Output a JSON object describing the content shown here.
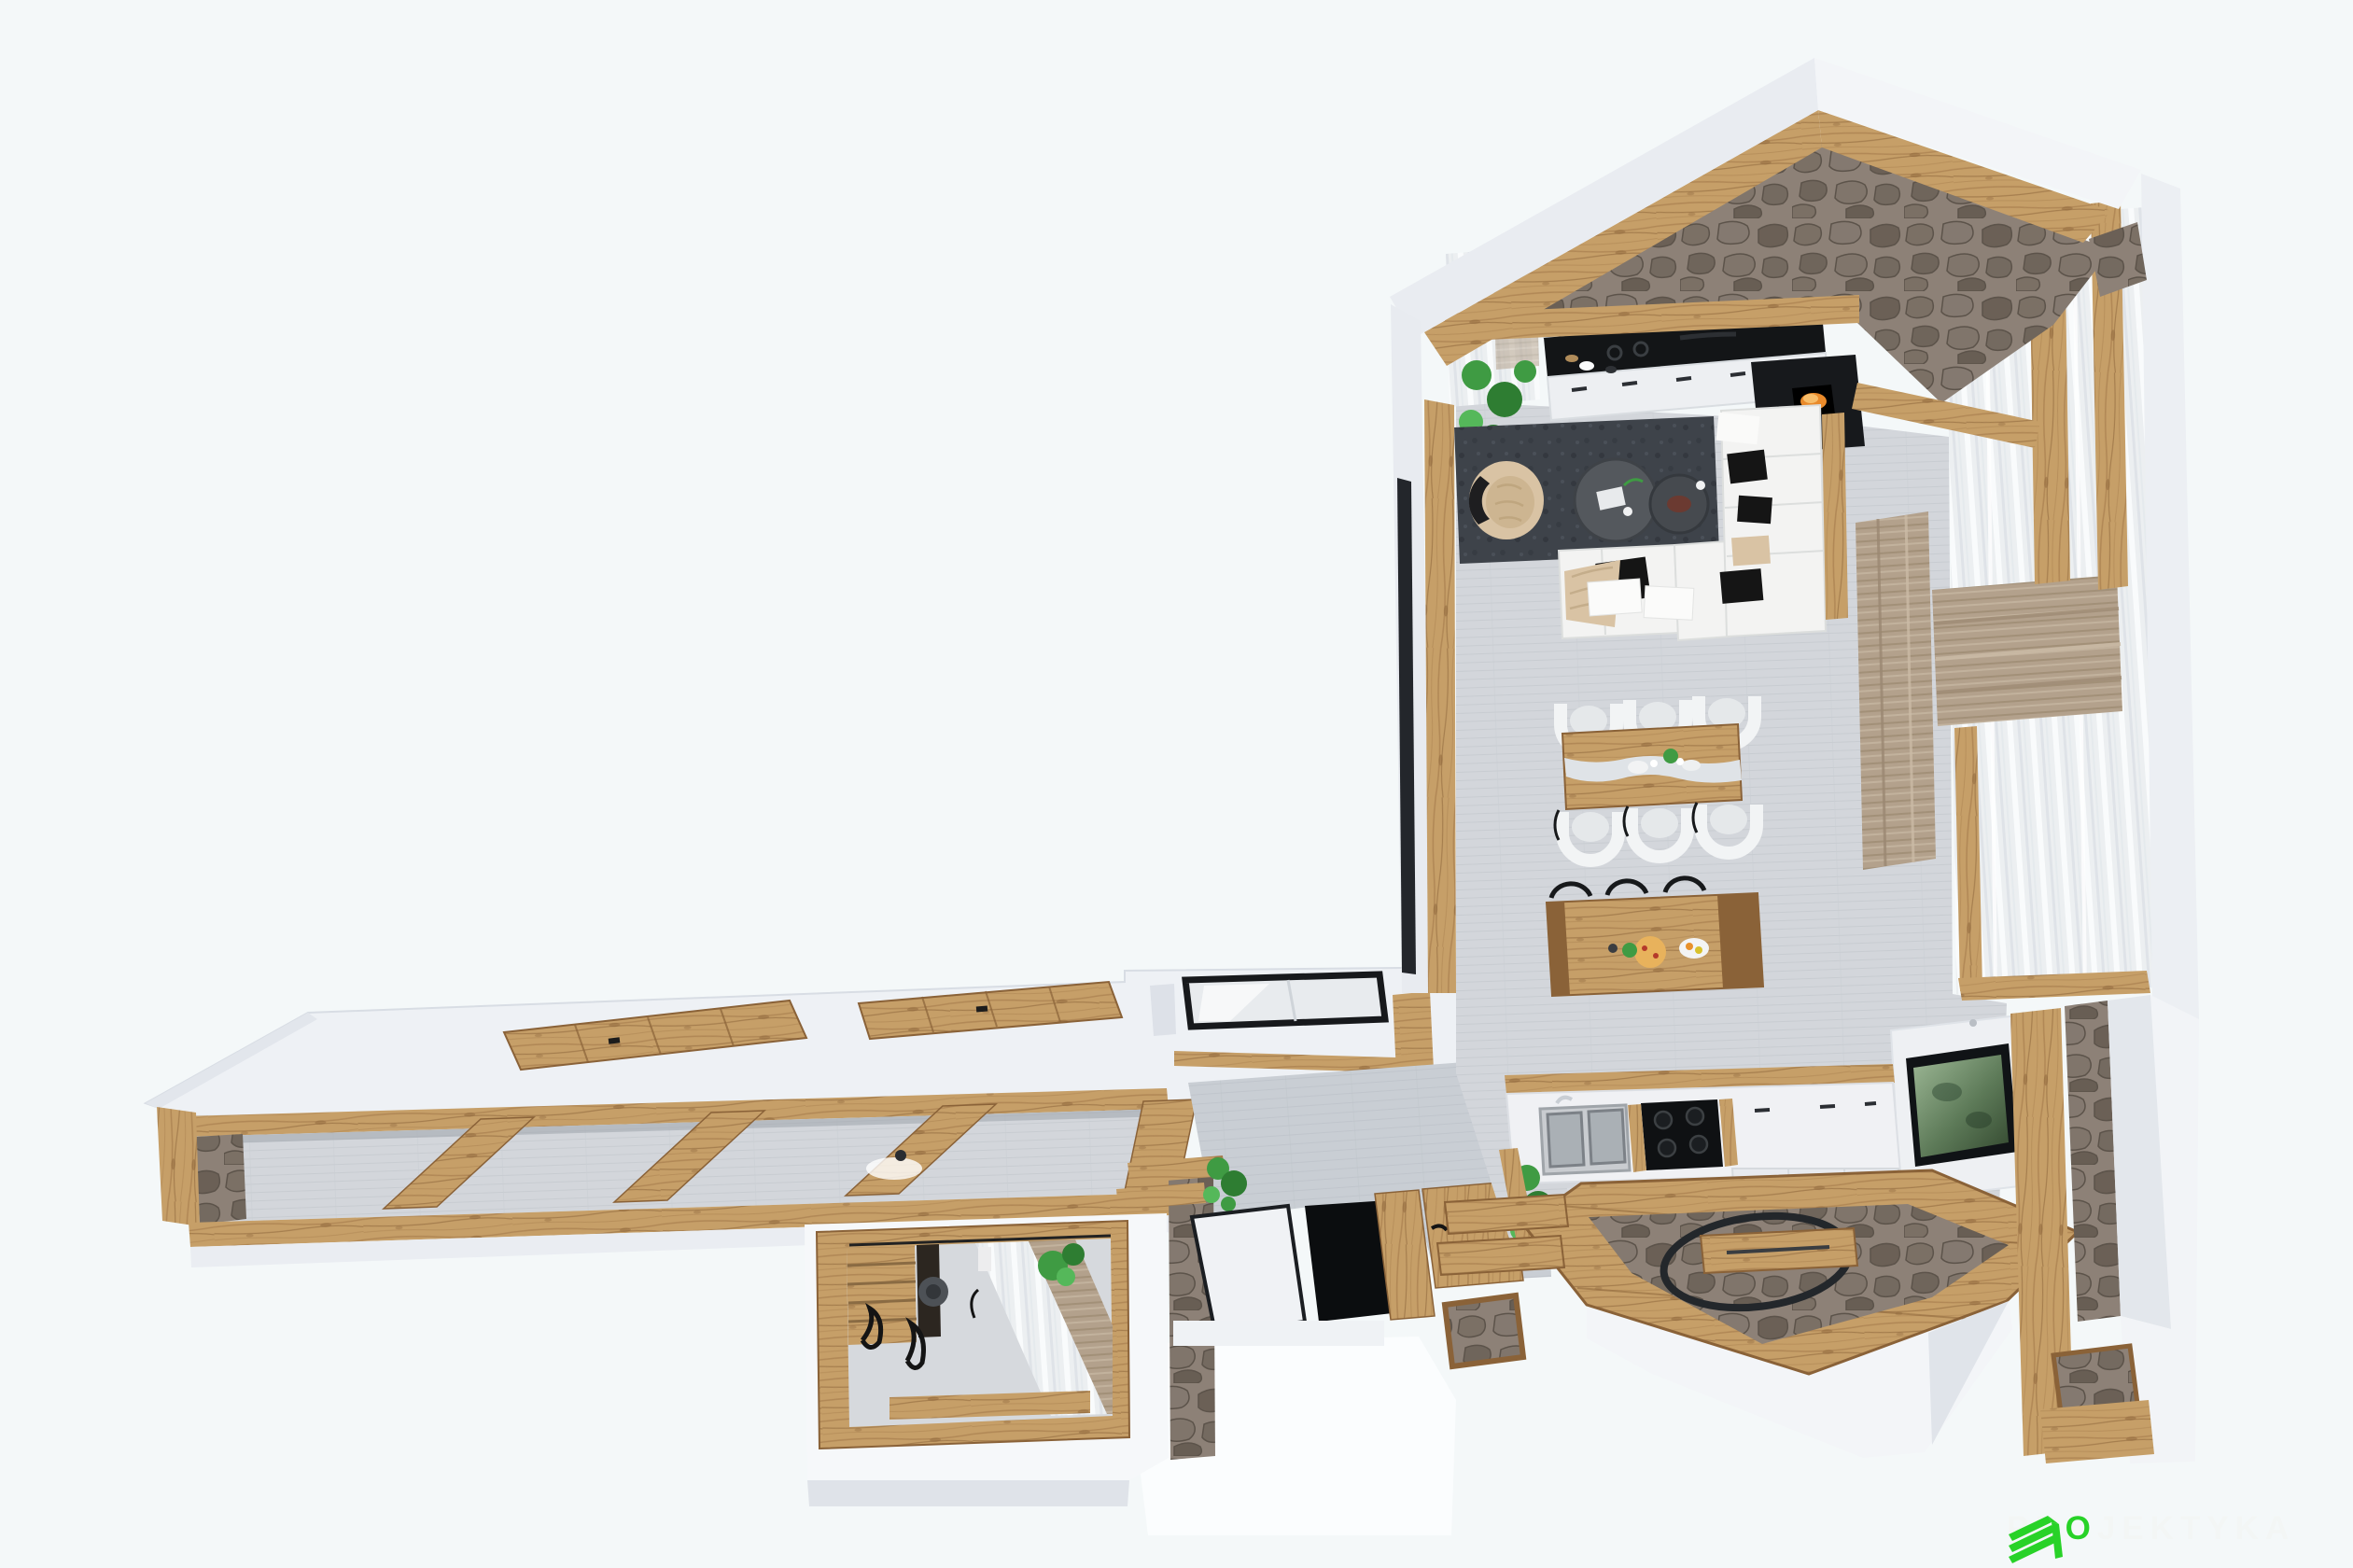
{
  "image": {
    "kind": "3d-floor-plan-render",
    "view": "top-down cutaway axonometric",
    "style": "chalet interior, natural timber and stone with white walls"
  },
  "watermark": {
    "text": "PROJEKTYKA",
    "pre": "PR",
    "accent_letter": "O",
    "post": "JEKTYKA",
    "logo": "green-layered-building-logo"
  },
  "palette": {
    "background": "#f4f8f9",
    "wall_white": "#eef1f5",
    "wall_white_bright": "#f6f8fa",
    "wall_shadow": "#dde1e8",
    "wood": "#c69f68",
    "wood_dark": "#a87f4e",
    "wood_deep": "#8a6238",
    "stone": "#8d8177",
    "stone_dark": "#5c534a",
    "floor_grey": "#d3d6db",
    "wall_grey": "#c9ced4",
    "rug_charcoal": "#3e434a",
    "sofa_white": "#f3f3f2",
    "pillow_black": "#151515",
    "beige": "#d9c3a4",
    "table_dark": "#54585d",
    "glass_grey": "#e9ecef",
    "drape_taupe": "#b3a18c",
    "sheer_white": "#eceff1",
    "plant_green": "#3f9b43",
    "plant_green_dark": "#2e7d32",
    "plant_green_light": "#55b85a",
    "flame_orange": "#e98a2b",
    "tv_green": "#56744f",
    "black": "#0b0d0f",
    "dark_window": "#23262b",
    "watermark_green": "#28d228",
    "watermark_text": "#f3f6f5"
  },
  "scene": {
    "areas": [
      {
        "id": "great-room",
        "name": "open living / kitchen room with gable roof",
        "items": [
          "white-gable-roof-band",
          "timber-rafters",
          "stone-gable-wall",
          "timber-collar-beam",
          "kitchen-wall-units",
          "glass-upper-cabinets",
          "black-cooktop-counter",
          "fireplace-black-unit",
          "left-window-sheer-curtain",
          "monstera-plant",
          "charcoal-rug",
          "beige-tufted-armchair",
          "round-coffee-table-large",
          "round-coffee-table-small",
          "white-corner-sofa",
          "black-pillows",
          "beige-throw",
          "timber-console",
          "timber-dining-table",
          "white-dining-chairs",
          "timber-kitchen-island",
          "bar-stool-black-frames",
          "pizza",
          "fruit-bowl",
          "wall-tv-green-artwork",
          "panorama-windows",
          "taupe-roman-shade",
          "taupe-drape",
          "timber-window-posts"
        ],
        "dining_chair_count": 6,
        "bar_stool_count": 3
      },
      {
        "id": "back-kitchen",
        "name": "second kitchen run at entry",
        "items": [
          "white-cabinet-run",
          "double-sink",
          "black-induction-hob",
          "white-sink-cart",
          "herb-plants",
          "timber-trims",
          "white-island-block"
        ]
      },
      {
        "id": "entry-terrace",
        "name": "stone entry terrace",
        "items": [
          "timber-deck-frame",
          "stone-paving",
          "black-oval-wire-basket",
          "timber-plank",
          "timber-steps",
          "stone-step-landing",
          "timber-entry-portal",
          "stone-door-strip"
        ]
      },
      {
        "id": "stair-hall",
        "name": "stair hall with skylight",
        "items": [
          "skylight-glass-panel",
          "white-door-panel",
          "black-stair-opening",
          "timber-stair-treads",
          "monstera-plant",
          "grey-plaster-wall",
          "timber-ledges",
          "stone-wall-strip"
        ]
      },
      {
        "id": "left-wing-attic",
        "name": "cut-away attic corridor wing",
        "items": [
          "white-roof-slab",
          "timber-access-hatches",
          "timber-cutaway-rails",
          "exposed-timber-joists",
          "stone-end-wall",
          "ceiling-spot-light",
          "grey-screed-floor"
        ],
        "hatch_count": 2,
        "joist_count": 4
      },
      {
        "id": "annex-room",
        "name": "small cut-away annex room",
        "items": [
          "timber-frame-cutaway",
          "timber-slat-wall",
          "sheer-striped-curtain",
          "taupe-curtain",
          "potted-plant",
          "round-wall-speaker",
          "wrought-iron-decor",
          "timber-sill"
        ]
      }
    ]
  }
}
